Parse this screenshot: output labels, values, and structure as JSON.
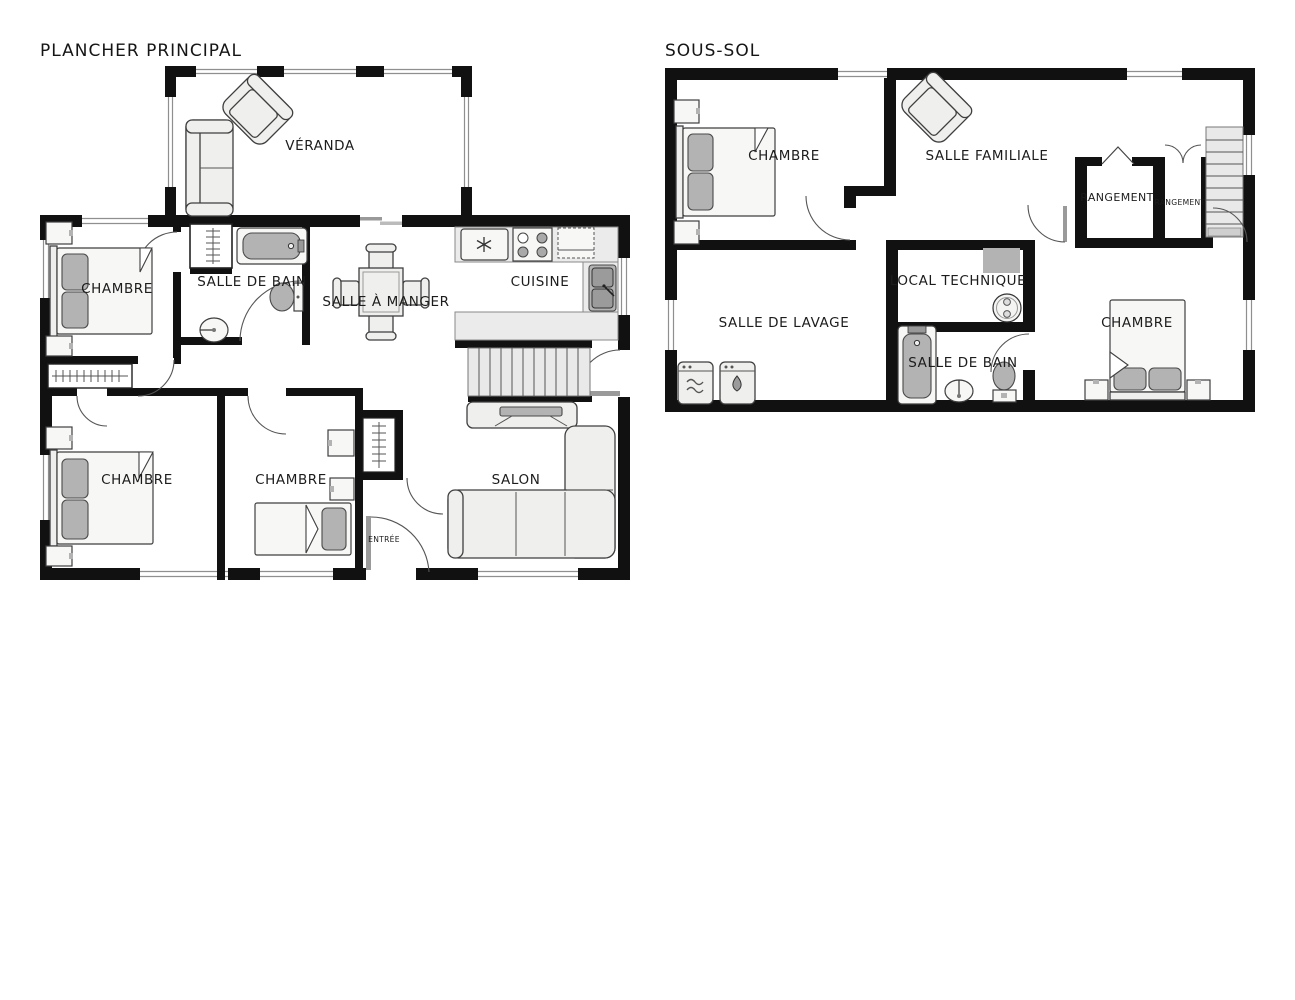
{
  "colors": {
    "wall": "#111111",
    "label": "#1c1c1c",
    "furniture-fill": "#efefed",
    "furniture-stroke": "#3f3f3f",
    "accent-gray": "#b3b3b3",
    "counter-fill": "#ebebeb",
    "window-line": "#8f8f8f",
    "door-arc": "#555555",
    "floor": "#ffffff"
  },
  "floors": [
    {
      "title": "PLANCHER PRINCIPAL",
      "rooms": [
        {
          "label": "VÉRANDA"
        },
        {
          "label": "CHAMBRE"
        },
        {
          "label": "SALLE DE BAIN"
        },
        {
          "label": "SALLE À MANGER"
        },
        {
          "label": "CUISINE"
        },
        {
          "label": "CHAMBRE"
        },
        {
          "label": "CHAMBRE"
        },
        {
          "label": "SALON"
        },
        {
          "label": "ENTRÉE"
        }
      ]
    },
    {
      "title": "SOUS-SOL",
      "rooms": [
        {
          "label": "CHAMBRE"
        },
        {
          "label": "SALLE FAMILIALE"
        },
        {
          "label": "RANGEMENT"
        },
        {
          "label": "RANGEMENT"
        },
        {
          "label": "SALLE DE LAVAGE"
        },
        {
          "label": "LOCAL TECHNIQUE"
        },
        {
          "label": "SALLE DE BAIN"
        },
        {
          "label": "CHAMBRE"
        }
      ]
    }
  ]
}
